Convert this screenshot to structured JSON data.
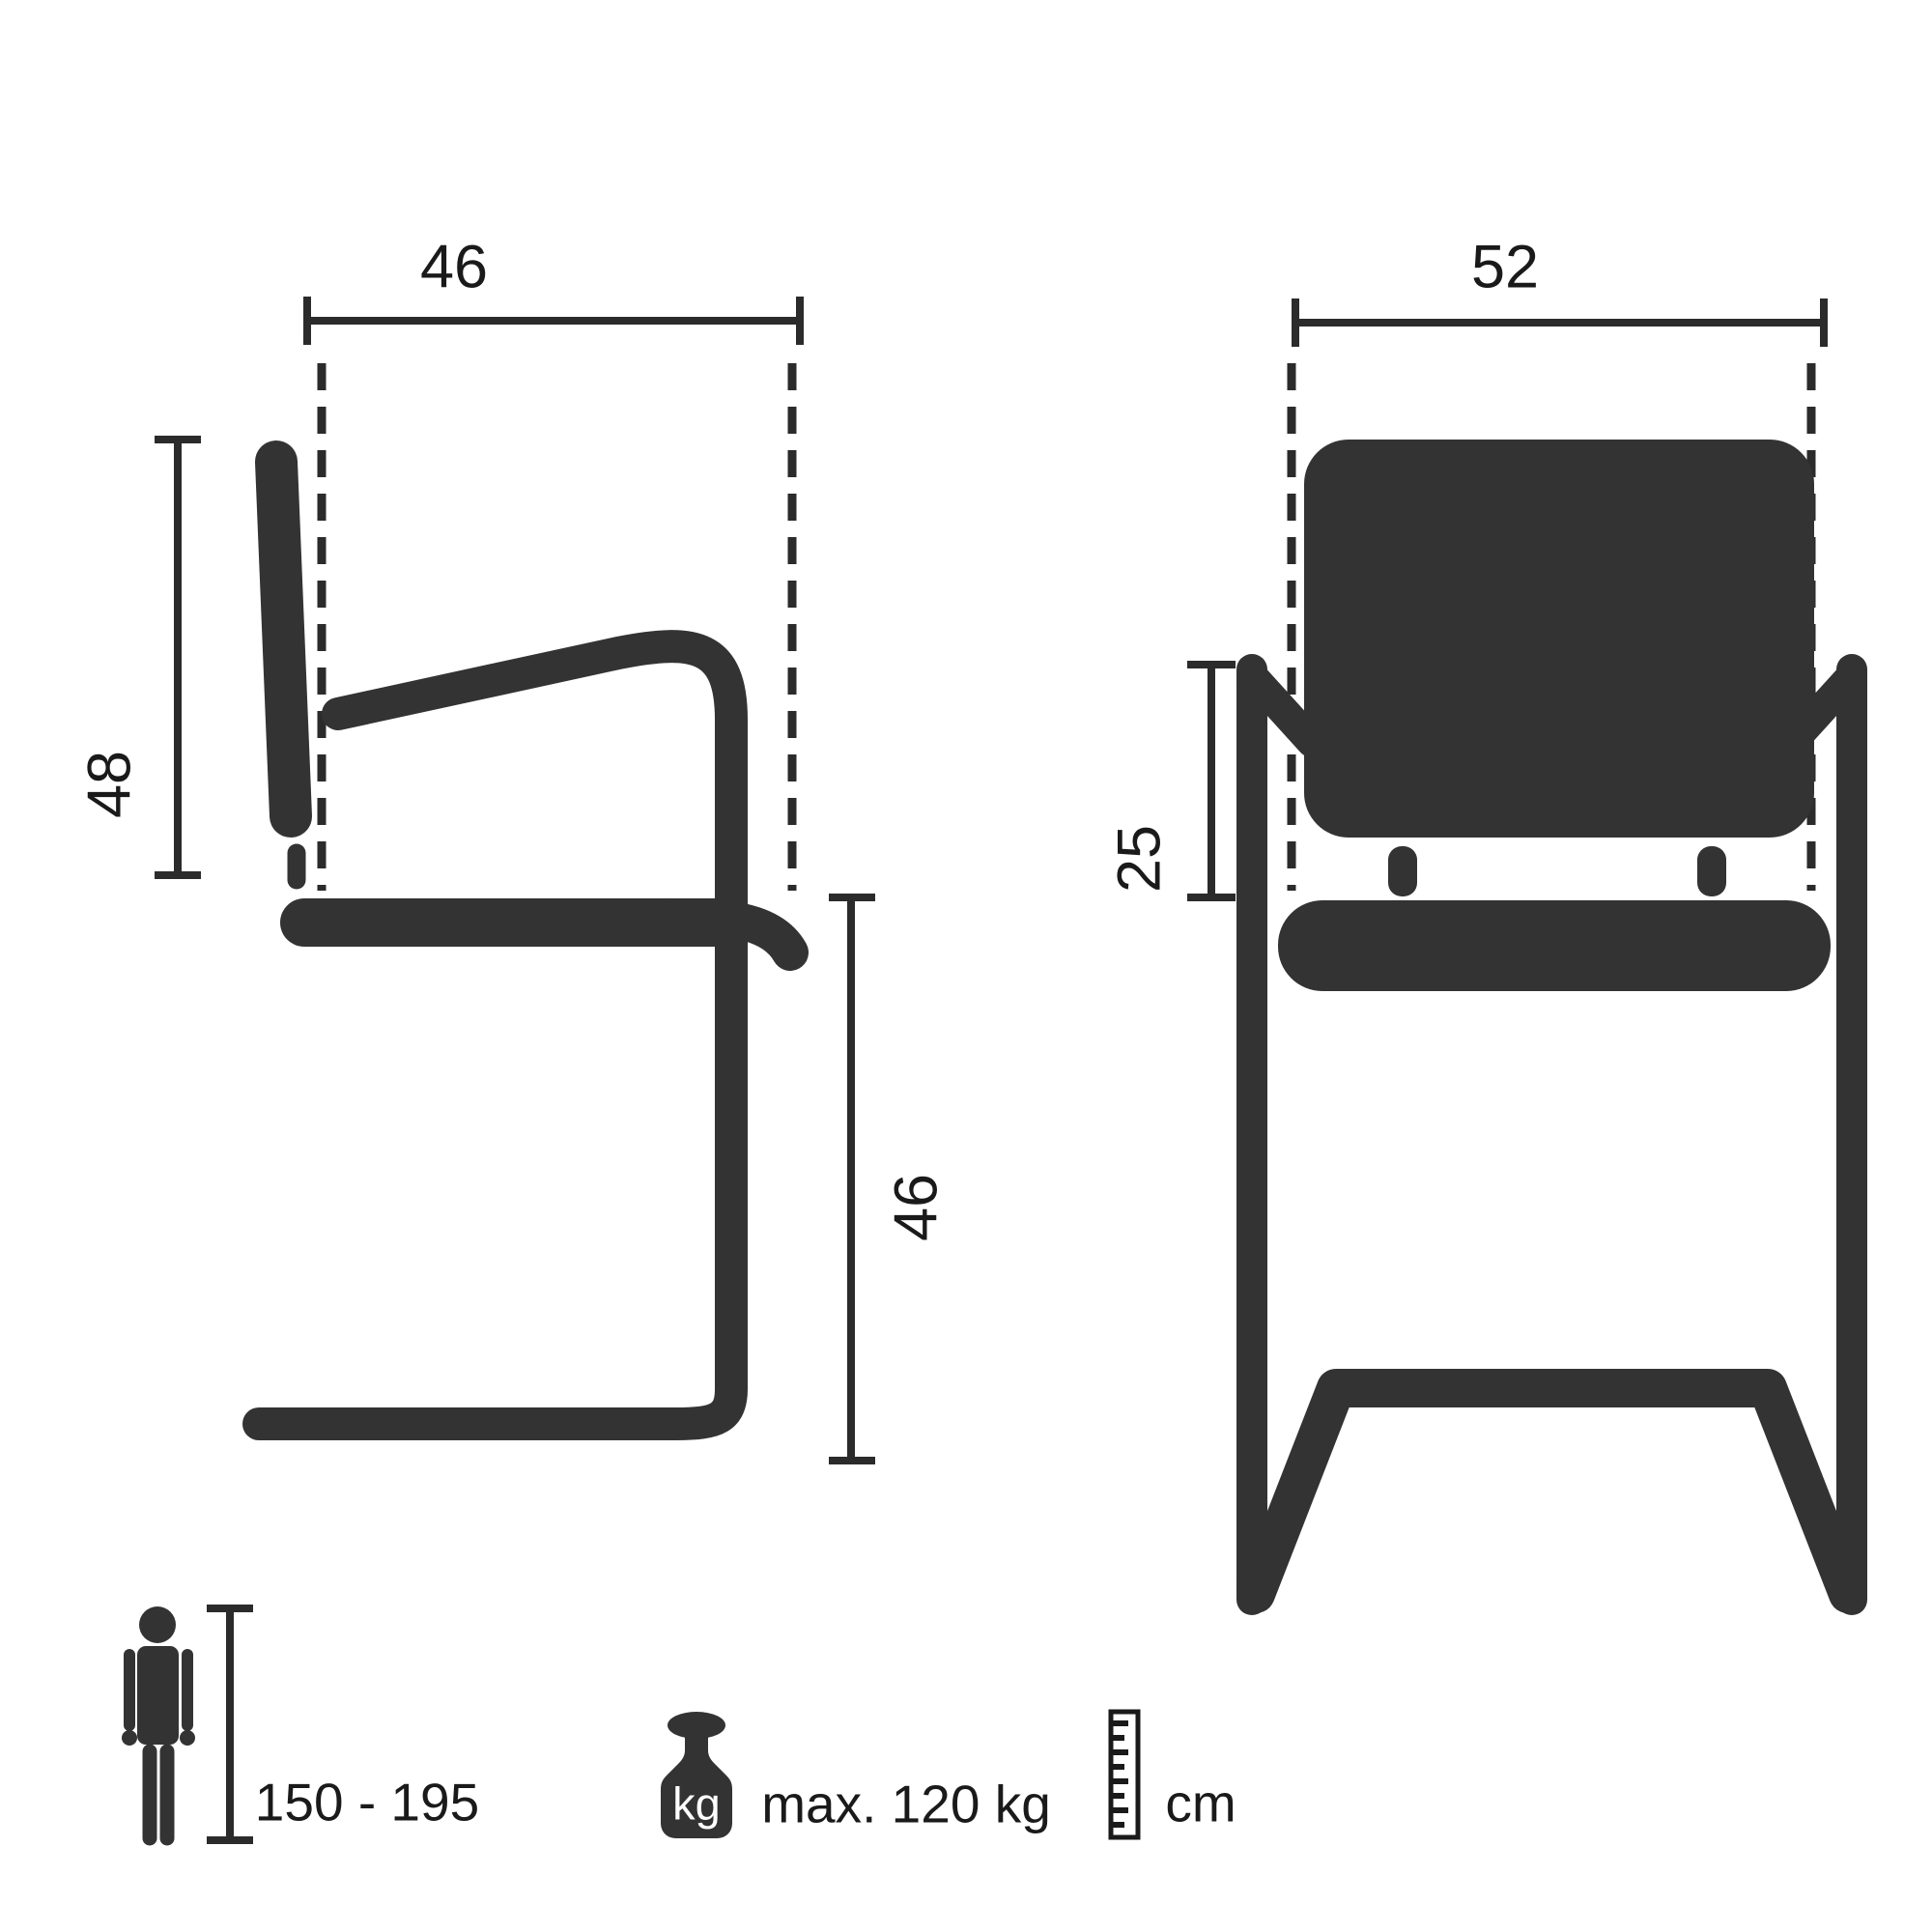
{
  "diagram_title": "chair-dimensions-diagram",
  "colors": {
    "background": "#ffffff",
    "chair_shape": "#333333",
    "dimension_lines": "#2b2b2b",
    "text": "#1a1a1a",
    "kg_label_on_weight": "#ffffff"
  },
  "side_view": {
    "top_width": "46",
    "backrest_height": "48",
    "seat_height": "46"
  },
  "front_view": {
    "top_width": "52",
    "armrest_above_seat": "25"
  },
  "legend": {
    "body_height_range": "150 - 195",
    "weight_icon_label": "kg",
    "max_load": "max. 120 kg",
    "unit": "cm"
  }
}
